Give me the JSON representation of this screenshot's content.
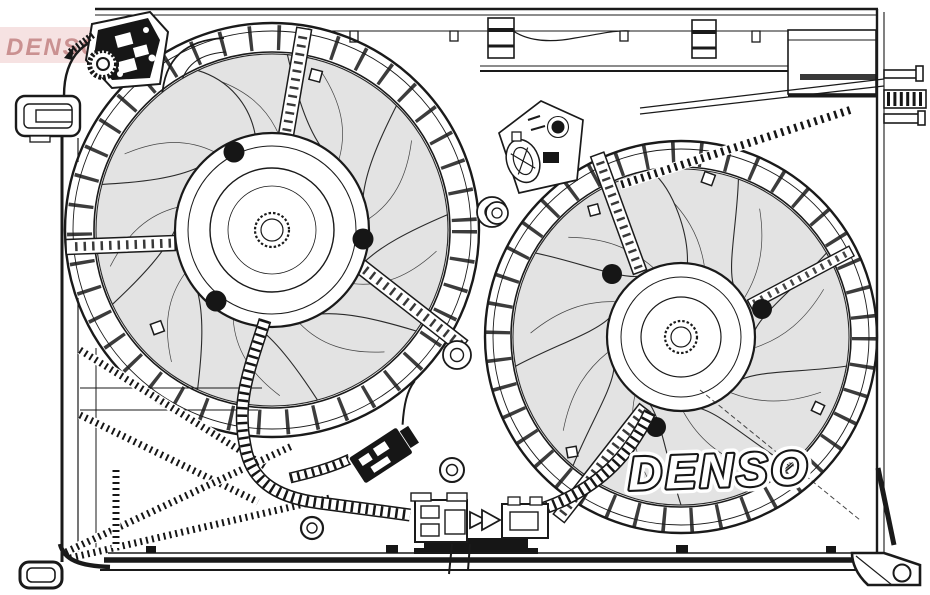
{
  "image": {
    "description": "Black-and-white technical line drawing of a dual radiator cooling fan assembly (two axial fans in a plastic shroud with wiring harness, connectors and mounting brackets)",
    "background_color": "#ffffff",
    "line_color": "#1a1a1a",
    "blade_fill_color": "#e3e3e3"
  },
  "watermark": {
    "text": "DENSO",
    "band_color": "#f6e2e2",
    "text_color": "#ca9191"
  },
  "brand_logo": {
    "text": "DENSO",
    "fill_color": "#ffffff",
    "outline_color": "#161616"
  }
}
